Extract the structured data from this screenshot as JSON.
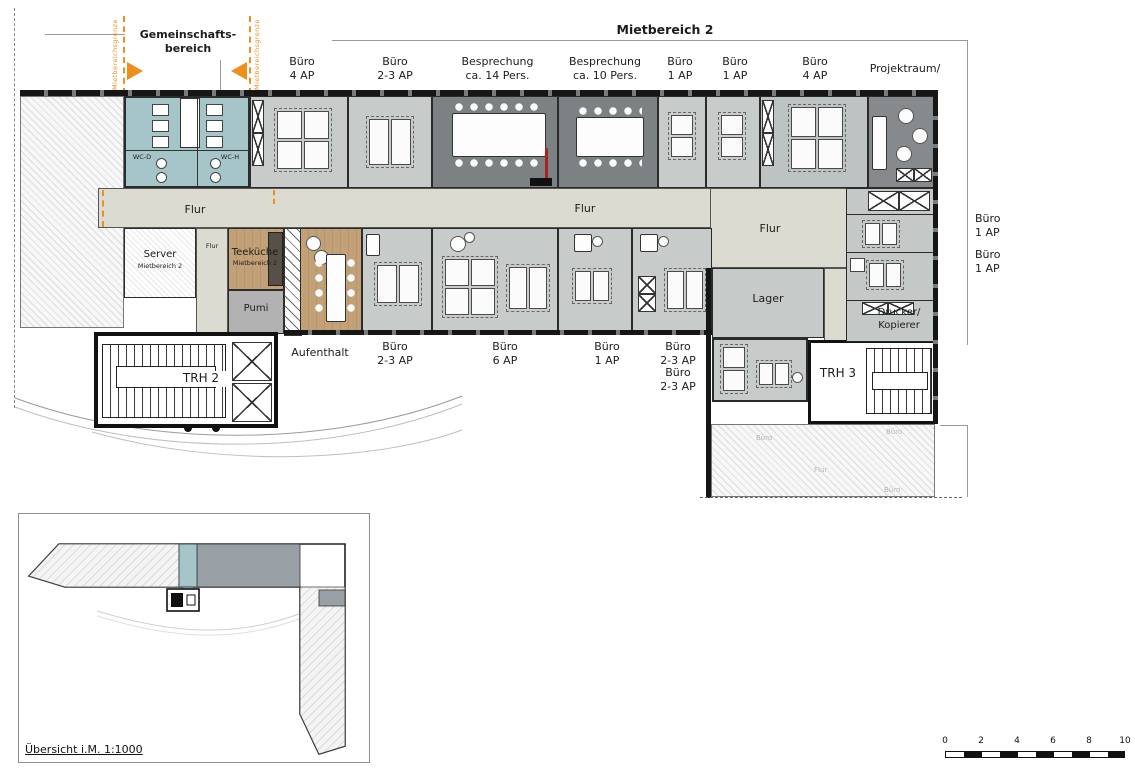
{
  "annotations": {
    "common_area": "Gemeinschafts-\nbereich",
    "boundary_left": "Mietbereichsgrenze",
    "boundary_right": "Mietbereichsgrenze",
    "area_title": "Mietbereich 2"
  },
  "labels": {
    "top": [
      "Büro\n4 AP",
      "Büro\n2-3 AP",
      "Besprechung\nca. 14 Pers.",
      "Besprechung\nca. 10 Pers.",
      "Büro\n1 AP",
      "Büro\n1 AP",
      "Büro\n4 AP"
    ],
    "projektraum": {
      "l1": "Projektraum/",
      "l2": "opt.Büro",
      "l3": "3 AP"
    },
    "bottom": [
      "Aufenthalt",
      "Büro\n2-3 AP",
      "Büro\n6 AP",
      "Büro\n1 AP",
      "Büro\n2-3 AP",
      "Büro\n2-3 AP"
    ],
    "right": [
      "Büro\n1 AP",
      "Büro\n1 AP"
    ]
  },
  "rooms": {
    "wc_d": "WC-D",
    "wc_h": "WC-H",
    "server": "Server",
    "server_sub": "Mietbereich 2",
    "teekueche": "Teeküche",
    "teekueche_sub": "Mietbereich 2",
    "pumi": "Pumi",
    "lager": "Lager",
    "drucker": "Drucker/\nKopierer",
    "trh2": "TRH 2",
    "trh3": "TRH 3",
    "flur_left": "Flur",
    "flur_center": "Flur",
    "flur_right": "Flur",
    "flur_small": "Flur"
  },
  "adjacent_faint_labels": [
    "Büro",
    "Büro",
    "Flur",
    "Büro"
  ],
  "overview": {
    "caption": "Übersicht i.M. 1:1000"
  },
  "scalebar": {
    "ticks": [
      "0",
      "2",
      "4",
      "6",
      "8",
      "10"
    ]
  },
  "colors": {
    "accent_orange": "#ee8e1d",
    "office_light": "#c7cbca",
    "office_medium": "#bdc2c2",
    "meeting_dark": "#7c8183",
    "projekt_dark": "#868a8d",
    "corridor": "#dbdbd2",
    "wc_teal": "#a6c5c8",
    "wood": "#c2a178",
    "pumi_gray": "#b2b2b2",
    "lager_gray": "#c6cac8",
    "overview_gray": "#9aa1a6"
  }
}
